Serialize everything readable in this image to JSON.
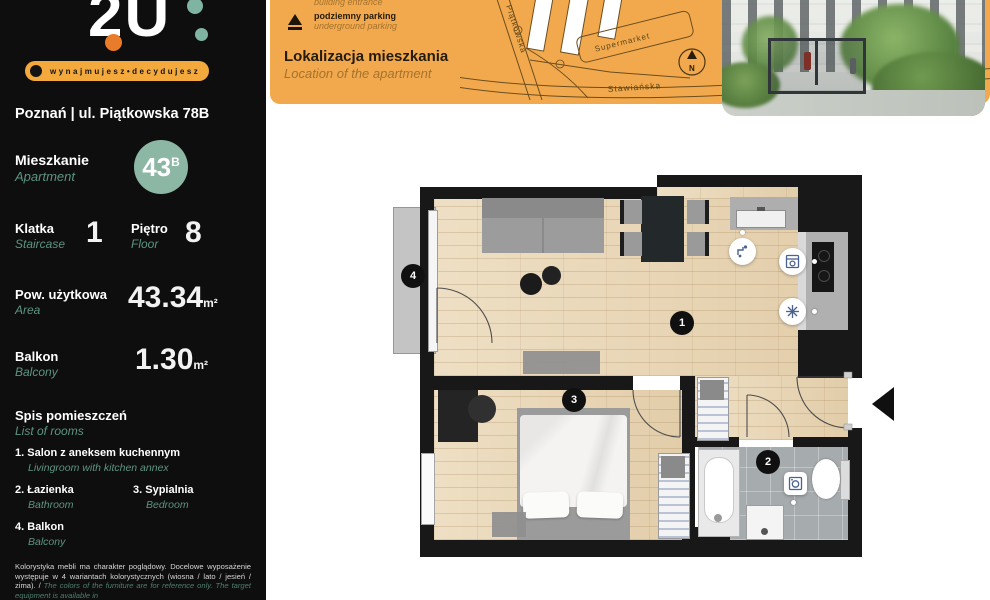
{
  "brand": {
    "logo_text": "2U",
    "tagline": "wynajmujesz•decydujesz"
  },
  "sidebar": {
    "address": "Poznań  |  ul. Piątkowska 78B",
    "apartment": {
      "label_pl": "Mieszkanie",
      "label_en": "Apartment",
      "number": "43",
      "suffix": "B"
    },
    "staircase": {
      "label_pl": "Klatka",
      "label_en": "Staircase",
      "value": "1"
    },
    "floor": {
      "label_pl": "Piętro",
      "label_en": "Floor",
      "value": "8"
    },
    "area": {
      "label_pl": "Pow. użytkowa",
      "label_en": "Area",
      "value": "43.34",
      "unit": "m²"
    },
    "balcony": {
      "label_pl": "Balkon",
      "label_en": "Balcony",
      "value": "1.30",
      "unit": "m²"
    },
    "rooms_header": {
      "pl": "Spis pomieszczeń",
      "en": "List of rooms"
    },
    "rooms": [
      {
        "num": "1.",
        "pl": "Salon z aneksem kuchennym",
        "en": "Livingroom with kitchen annex"
      },
      {
        "num": "2.",
        "pl": "Łazienka",
        "en": "Bathroom"
      },
      {
        "num": "3.",
        "pl": "Sypialnia",
        "en": "Bedroom"
      },
      {
        "num": "4.",
        "pl": "Balkon",
        "en": "Balcony"
      }
    ],
    "disclaimer_pl": "Kolorystyka mebli ma charakter poglądowy. Docelowe wyposażenie występuje w 4 wariantach kolorystycznych (wiosna / lato / jesień / zima). / ",
    "disclaimer_en": "The colors of the furniture are for reference only. The target equipment is available in"
  },
  "map_panel": {
    "legend": [
      {
        "pl": "wejście do budynku",
        "en": "building entrance"
      },
      {
        "pl": "podziemny parking",
        "en": "underground parking"
      }
    ],
    "title_pl": "Lokalizacja mieszkania",
    "title_en": "Location of the apartment",
    "street_vertical": "Piątkowska",
    "street_bottom": "Stawiańska",
    "supermarket_label": "Supermarket",
    "compass_letter": "N"
  },
  "plan": {
    "markers": [
      {
        "label": "1",
        "room": "livingroom-with-kitchen-annex"
      },
      {
        "label": "2",
        "room": "bathroom"
      },
      {
        "label": "3",
        "room": "bedroom"
      },
      {
        "label": "4",
        "room": "balcony"
      }
    ],
    "appliances": [
      {
        "icon": "faucet"
      },
      {
        "icon": "oven"
      },
      {
        "icon": "fridge-snowflake"
      },
      {
        "icon": "washing-machine"
      }
    ]
  },
  "colors": {
    "accent_orange": "#f2a94d",
    "pill_orange": "#f3a93c",
    "teal": "#5c9482",
    "apartment_circle": "#8cb7a5",
    "wall_black": "#181818",
    "wood_floor": "#e7d5b6",
    "tile_gray": "#a6abae"
  }
}
